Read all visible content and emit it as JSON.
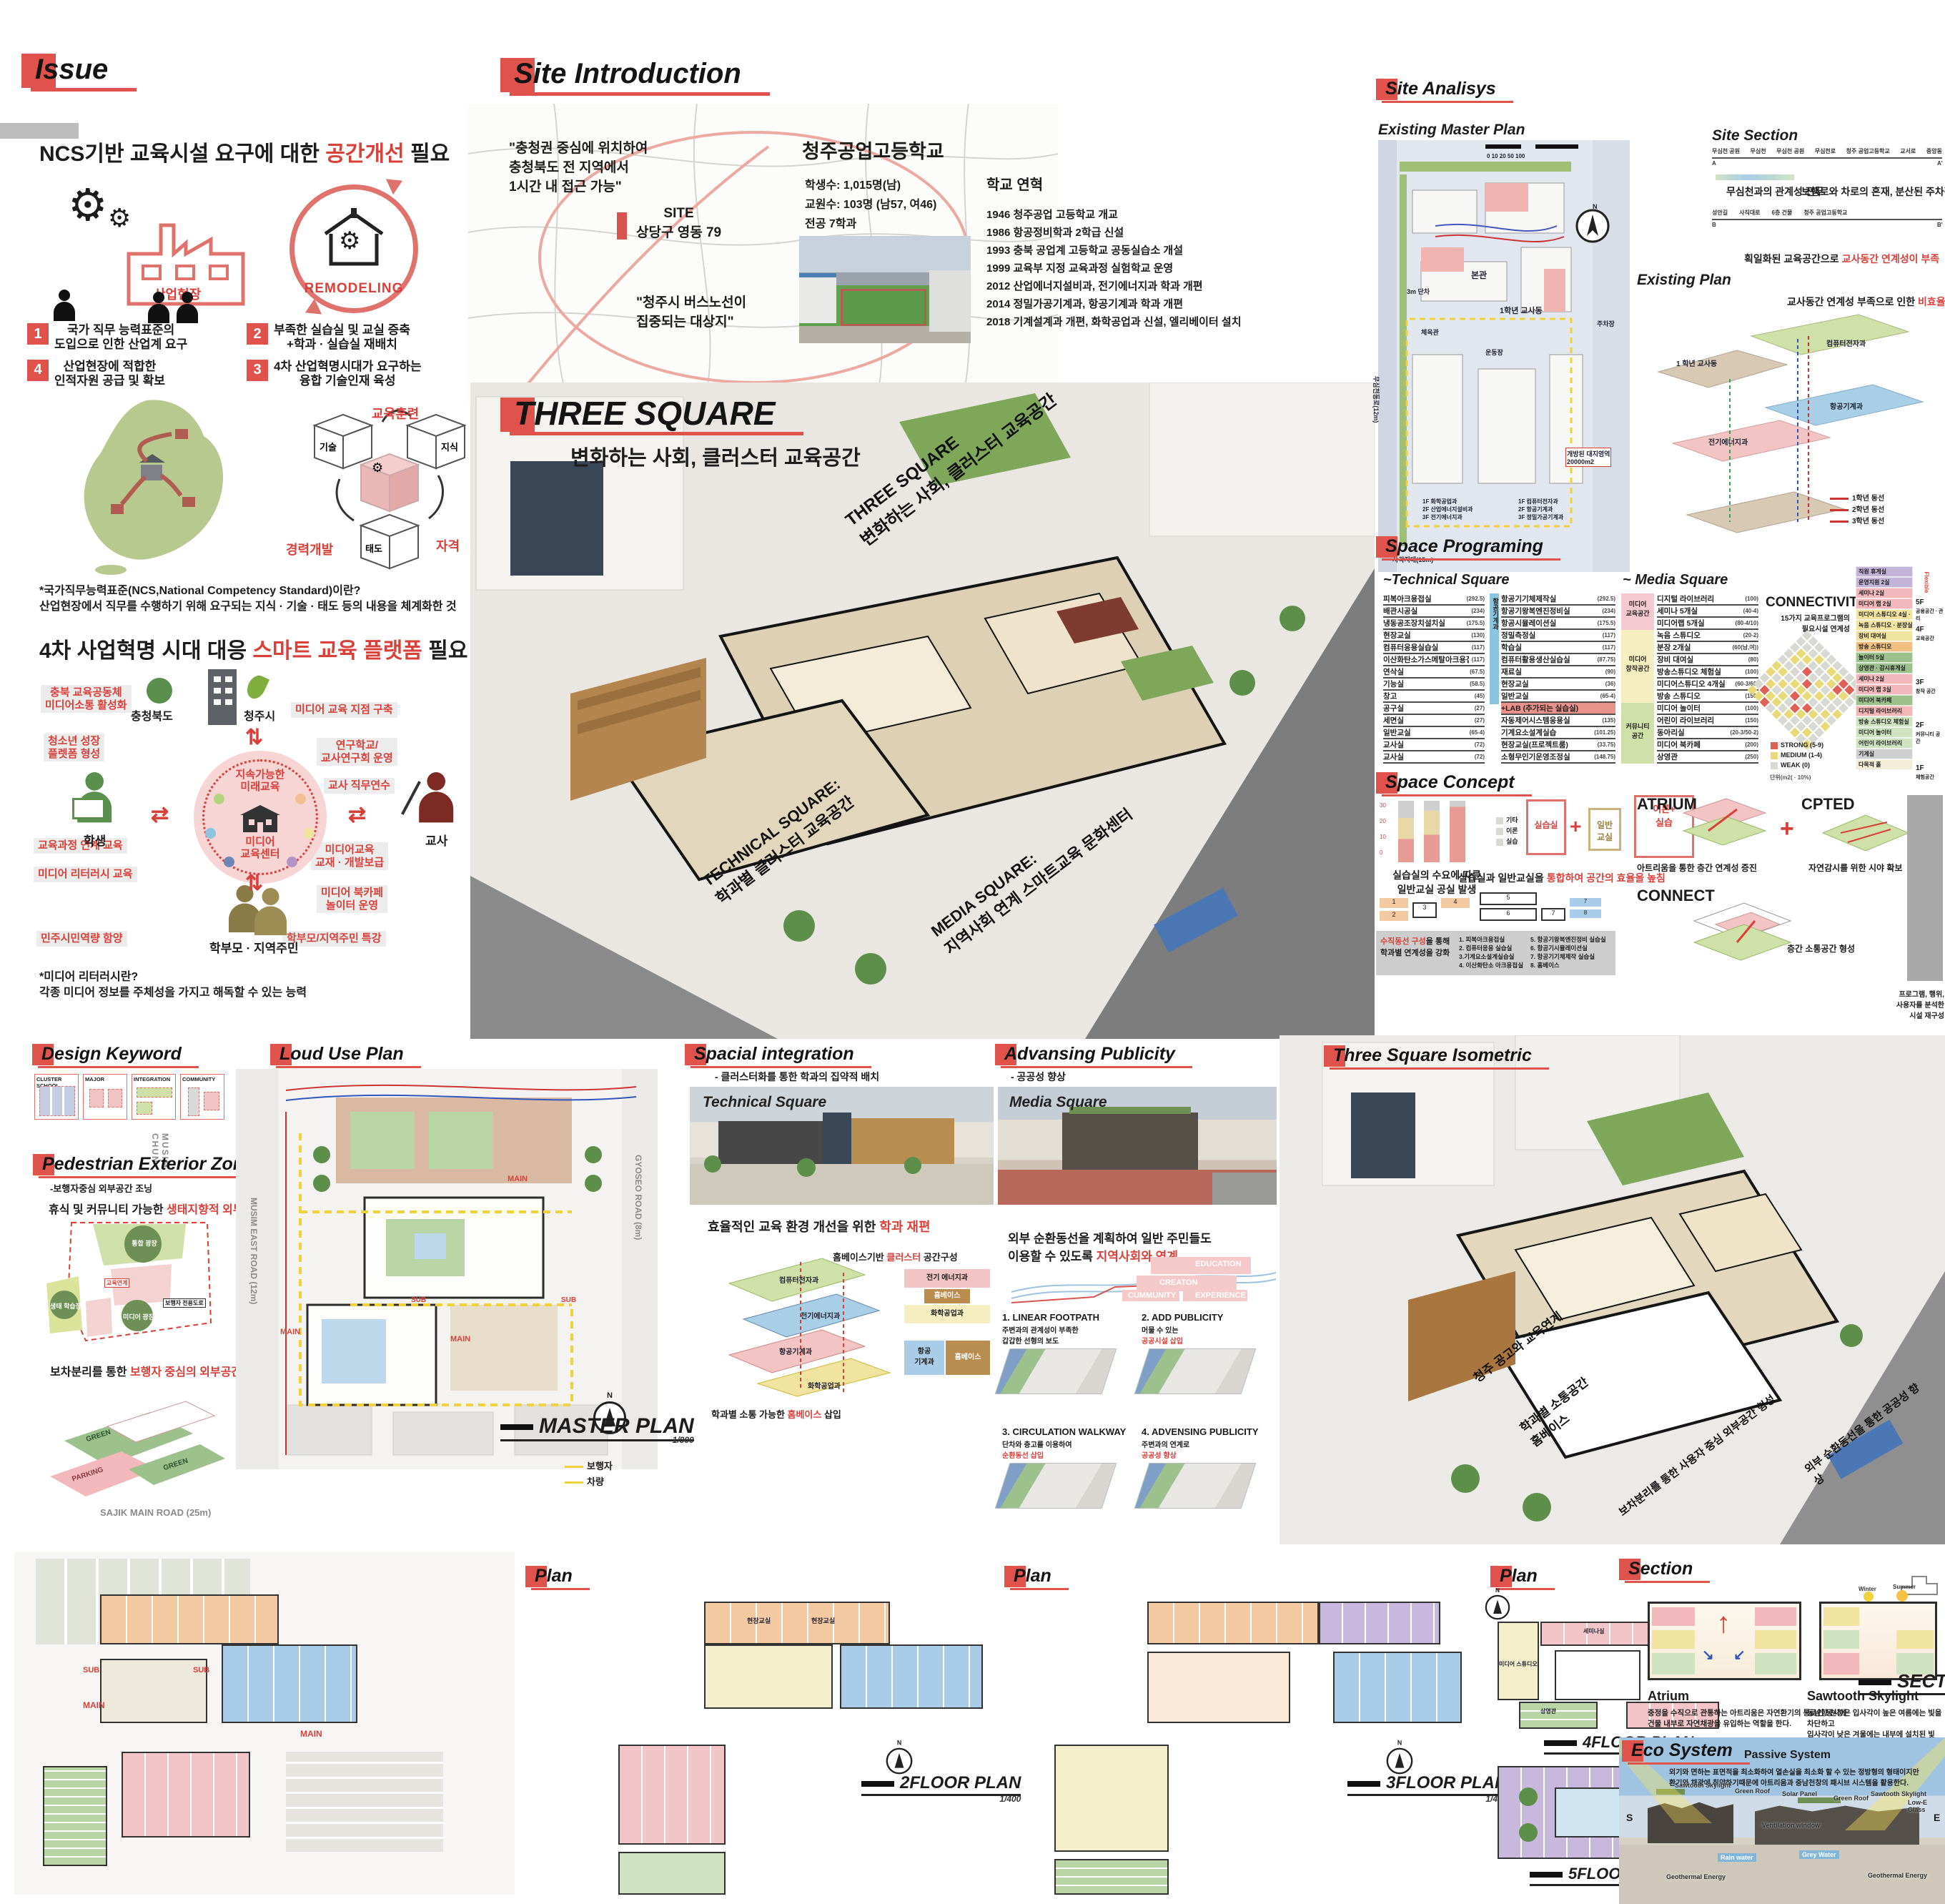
{
  "colors": {
    "accent": "#e0524c",
    "red_text": "#d9403a",
    "pink": "#f2b8bc",
    "yellow": "#f1e3a0",
    "green": "#9dc18c",
    "blue": "#a9cde8",
    "orange": "#f0c083",
    "purple": "#c3b3d6"
  },
  "misc": {
    "n": "N",
    "plus": "+"
  },
  "issue": {
    "header": "Issue",
    "h1_pre": "NCS기반 교육시설 요구에 대한 ",
    "h1_red": "공간개선",
    "h1_post": " 필요",
    "factory_label": "산업현장",
    "remodeling_label": "REMODELING",
    "items": [
      {
        "num": "1",
        "text": "국가 직무 능력표준의\n도입으로 인한 산업계 요구"
      },
      {
        "num": "2",
        "text": "부족한 실습실 및 교실 증축\n+학과 · 실습실 재배치"
      },
      {
        "num": "4",
        "text": "산업현장에 적합한\n인적자원 공급 및 확보"
      },
      {
        "num": "3",
        "text": "4차 산업혁명시대가 요구하는\n융합 기술인재 육성"
      }
    ],
    "cube": {
      "top": "교육훈련",
      "left": "경력개발",
      "right": "자격",
      "c1": "기술",
      "c2": "지식",
      "c3": "태도"
    },
    "note1_title": "*국가직무능력표준(NCS,National Competency Standard)이란?",
    "note1_body": "산업현장에서 직무를 수행하기 위해 요구되는 지식 ·  기술 · 태도 등의 내용을 체계화한 것",
    "h2_pre": "4차 사업혁명 시대 대응 ",
    "h2_red": "스마트 교육 플랫폼",
    "h2_post": " 필요",
    "platform": {
      "org_left": "충청북도",
      "org_right": "청주시",
      "center_top": "지속가능한\n미래교육",
      "center_bottom": "미디어\n교육센터",
      "actor_left": "학생",
      "actor_right": "교사",
      "actor_bottom": "학부모 · 지역주민",
      "tags_left": [
        "충북 교육공동체\n미디어소통 활성화",
        "청소년 성장\n플렛폼 형성",
        "교육과정 연계 교육",
        "미디어 리터러시 교육",
        "민주시민역량 함양"
      ],
      "tags_right": [
        "미디어 교육 지점 구축",
        "연구학교/\n교사연구회 운영",
        "교사 직무연수",
        "미디어교육\n교재 · 개발보급",
        "미디어 북카페\n놀이터 운영",
        "학부모/지역주민 특강"
      ]
    },
    "note2_title": "*미디어 리터러시란?",
    "note2_body": "각종 미디어 정보를 주체성을 가지고 해독할 수 있는 능력"
  },
  "site_intro": {
    "header": "Site Introduction",
    "quote1": "\"충청권 중심에 위치하여\n충청북도 전 지역에서\n1시간 내 접근 가능\"",
    "site_label": "SITE\n상당구 영동 79",
    "quote2": "\"청주시 버스노선이\n집중되는 대상지\"",
    "school_name": "청주공업고등학교",
    "stats": [
      "학생수: 1,015명(남)",
      "교원수: 103명 (남57, 여46)",
      "전공 7학과"
    ],
    "history_title": "학교 연혁",
    "history": [
      "1946 청주공업 고등학교 개교",
      "1986 항공정비학과 2학급 신설",
      "1993 충북 공업계 고등학교 공동실습소 개설",
      "1999 교육부 지정 교육과정 실험학교 운영",
      "2012 산업에너지설비과, 전기에너지과 학과 개편",
      "2014 정밀가공기계과, 항공기계과 학과 개편",
      "2018 기계설계과 개편, 화학공업과 신설, 엘리베이터 설치"
    ]
  },
  "three_square": {
    "title": "THREE SQUARE",
    "subtitle": "변화하는 사회, 클러스터 교육공간",
    "roof_label": "THREE SQUARE\n변화하는 사회, 클러스터 교육공간",
    "technical_label": "TECHNICAL SQUARE:\n학과별 클러스터 교육공간",
    "media_label": "MEDIA SQUARE:\n지역사회 연계 스마트교육 문화센터"
  },
  "analysis": {
    "header": "Site Analisys",
    "master_title": "Existing Master Plan",
    "scalebar": "0  10  20        50                100",
    "plan_labels": {
      "main": "본관",
      "grade1": "1학년 교사동",
      "gym": "체육관",
      "ground": "운동장",
      "parking": "주차장",
      "gap": "3m 단차",
      "blind": "사각지대(15m)",
      "open": "개방된 대지영역\n20000m2",
      "stack1": "1F 화학공업과\n2F 산업에너지설비과\n3F 전기에너지과",
      "stack2": "1F 컴퓨터전자과\n2F 항공기계과\n3F 정밀가공기계과",
      "road": "무심천동로(12m)"
    },
    "section_title": "Site Section",
    "sec1_ticks": [
      "무심천 공원",
      "무심천",
      "무심천 공원",
      "무심천로",
      "청주 공업고등학교",
      "교서로",
      "중앙동"
    ],
    "a": "A",
    "a2": "A'",
    "cap1": "무심천과의 관계성 전무",
    "cap2_pre": "보행로와 차로의 혼재, 분산된 주차장으로인한 ",
    "cap2_red": "비합리적 외부공간",
    "sec2_ticks": [
      "성안길",
      "사직대로",
      "6층 건물",
      "청주 공업고등학교"
    ],
    "b": "B",
    "b2": "B'",
    "cap3_pre": "획일화된 교육공간으로 ",
    "cap3_red": "교사동간 연계성이 부족",
    "plan_title": "Existing Plan",
    "plan_cap_pre": "교사동간 연계성 부족으로 인한 ",
    "plan_cap_red": "비효율적 동선",
    "axon_labels": [
      "1 학년 교사동",
      "컴퓨터전자과",
      "전기에너지과",
      "항공기계과"
    ],
    "legend": [
      {
        "label": "1학년 동선",
        "cls": "lg1"
      },
      {
        "label": "2학년 동선",
        "cls": "lg2"
      },
      {
        "label": "3학년 동선",
        "cls": "lg3"
      }
    ]
  },
  "programing": {
    "header": "Space Programing",
    "tech_title": "~Technical Square",
    "tech_side": "항공기계과",
    "media_title": "~ Media Square",
    "tech_col1": [
      {
        "name": "피복아크용접실",
        "area": "(292.5)"
      },
      {
        "name": "배관시공실",
        "area": "(234)"
      },
      {
        "name": "냉동공조장치설치실",
        "area": "(175.5)"
      },
      {
        "name": "현장교실",
        "area": "(130)"
      },
      {
        "name": "컴퓨터응용실습실",
        "area": "(117)"
      },
      {
        "name": "이산화탄소가스메탈아크용접실",
        "area": "(117)"
      },
      {
        "name": "연삭실",
        "area": "(67.5)"
      },
      {
        "name": "기능실",
        "area": "(58.5)"
      },
      {
        "name": "창고",
        "area": "(45)"
      },
      {
        "name": "공구실",
        "area": "(27)"
      },
      {
        "name": "세면실",
        "area": "(27)"
      },
      {
        "name": "일반교실",
        "area": "(65-4)"
      },
      {
        "name": "교사실",
        "area": "(72)"
      },
      {
        "name": "교사실",
        "area": "(72)"
      }
    ],
    "tech_col2": [
      {
        "name": "항공기기체제작실",
        "area": "(292.5)"
      },
      {
        "name": "항공기왕복엔진정비실",
        "area": "(234)"
      },
      {
        "name": "항공시뮬레이션실",
        "area": "(175.5)"
      },
      {
        "name": "정밀측정실",
        "area": "(117)"
      },
      {
        "name": "학습실",
        "area": "(117)"
      },
      {
        "name": "컴퓨터활용생산실습실",
        "area": "(87.75)"
      },
      {
        "name": "재료실",
        "area": "(90)"
      },
      {
        "name": "현장교실",
        "area": "(36)"
      },
      {
        "name": "일반교실",
        "area": "(65-4)"
      },
      {
        "name": "+LAB (추가되는 실습실)",
        "area": "",
        "cls": "labrow"
      },
      {
        "name": "자동제어시스템응용실",
        "area": "(135)"
      },
      {
        "name": "기계요소설계실습",
        "area": "(101.25)"
      },
      {
        "name": "현장교실(프로젝트룸)",
        "area": "(33.75)"
      },
      {
        "name": "소형무인기운영조정실",
        "area": "(148.75)"
      }
    ],
    "media_cats": [
      {
        "label": "미디어\n교육공간",
        "cls": "mc-pink"
      },
      {
        "label": "미디어\n창작공간",
        "cls": "mc-yellow"
      },
      {
        "label": "커뮤니티\n공간",
        "cls": "mc-green"
      }
    ],
    "media_rooms": [
      {
        "name": "디지털 라이브러리",
        "area": "(100)"
      },
      {
        "name": "세미나 5개실",
        "area": "(40-4)"
      },
      {
        "name": "미디어랩 5개실",
        "area": "(80-4/10)"
      },
      {
        "name": "녹음 스튜디오",
        "area": "(20-2)"
      },
      {
        "name": "분장 2개실",
        "area": "(60(남,여))"
      },
      {
        "name": "장비 대여실",
        "area": "(80)"
      },
      {
        "name": "방송스튜디오 체험실",
        "area": "(100)"
      },
      {
        "name": "미디어스튜디오 4개실",
        "area": "(60-3/60)"
      },
      {
        "name": "방송 스튜디오",
        "area": "(150)"
      },
      {
        "name": "미디어 놀이터",
        "area": "(100)"
      },
      {
        "name": "어린이 라이브러리",
        "area": "(150)"
      },
      {
        "name": "동아리실",
        "area": "(20-3/50-2)"
      },
      {
        "name": "미디어 북카페",
        "area": "(200)"
      },
      {
        "name": "상영관",
        "area": "(250)"
      }
    ],
    "connectivity": {
      "title": "CONNECTIVITY",
      "subtitle": "15가지 교육프로그램의\n필요시설 연계성",
      "legend": [
        {
          "label": "STRONG (5-9)",
          "cls": "ccr"
        },
        {
          "label": "MEDIUM (1-4)",
          "cls": "ccy"
        },
        {
          "label": "WEAK (0)",
          "cls": "ccw"
        }
      ],
      "unit": "단위(m2( · 10%)",
      "matrix": [
        "YWWYYWWWWW",
        "YRYWYWYYWW",
        "RYWYWWWYWW",
        "WYYWYWRWYW",
        "YWWRYRWWWW",
        "WYRWYWYWYW",
        "WWYRWYWYYW",
        "YWWYWWYRRW",
        "WYWWYWWYRW",
        "YWWYWYWWWY"
      ]
    },
    "stack_rows": [
      {
        "label": "직원 휴게실",
        "cls": "sv"
      },
      {
        "label": "운영지원 2실",
        "cls": "sv"
      },
      {
        "label": "세미나 2실",
        "cls": "sp"
      },
      {
        "label": "미디어 랩 2실",
        "cls": "sp"
      },
      {
        "label": "미디어 스튜디오 4실 · 조정실",
        "cls": "sy"
      },
      {
        "label": "녹음 스튜디오 · 분장실 2개실",
        "cls": "sy"
      },
      {
        "label": "장비 대여실",
        "cls": "sy"
      },
      {
        "label": "방송 스튜디오",
        "cls": "so"
      },
      {
        "label": "놀이터 5실",
        "cls": "sg"
      },
      {
        "label": "상영관 · 감시휴게실",
        "cls": "sg"
      },
      {
        "label": "세미나 2실",
        "cls": "sp"
      },
      {
        "label": "미디어 랩 3실",
        "cls": "sp"
      },
      {
        "label": "미디어 북카페",
        "cls": "sg"
      },
      {
        "label": "디지털 라이브러리",
        "cls": "srd"
      },
      {
        "label": "방송 스튜디오 체험실",
        "cls": "sg2"
      },
      {
        "label": "미디어 놀이터",
        "cls": "sg2"
      },
      {
        "label": "어린이 라이브러리",
        "cls": "sg2"
      },
      {
        "label": "기계실",
        "cls": "sgr"
      },
      {
        "label": "다목적 홀",
        "cls": "scr"
      }
    ],
    "stack_floors": [
      {
        "f": "5F",
        "zone": "공용공간 · 관리"
      },
      {
        "f": "4F",
        "zone": "교육공간"
      },
      {
        "f": "3F",
        "zone": "창작 공간"
      },
      {
        "f": "2F",
        "zone": "커뮤니티 공간"
      },
      {
        "f": "1F",
        "zone": "체험공간"
      }
    ],
    "flexible": "Flexible"
  },
  "concept": {
    "header": "Space Concept",
    "ticks": [
      "30",
      "20",
      "10",
      "0"
    ],
    "bar_legend": [
      "기타",
      "이론",
      "실습"
    ],
    "bars_caption": "실습실의 수요에 따른\n일반교실 공실 발생",
    "box_a": "실습실",
    "box_b": "일반\n교실",
    "box_c": "이론+\n실습",
    "cap2_pre": "실습실과 일반교실을 ",
    "cap2_red": "통합하여 공간의 효율을 높침",
    "cap3_red": "수직동선 구성",
    "cap3_post": "을 통해\n학과별 연계성을 강화",
    "legend1": [
      "1. 피복아크용접실",
      "2. 컴퓨터응용 실습실",
      "3.기계요소설계실습실",
      "4. 이산화탄소 아크용접실"
    ],
    "legend2": [
      "5. 항공기왕복엔진정비 실습실",
      "6. 항공기시뮬레이션실",
      "7. 항공기기체제작 실습실",
      "8. 홈베이스"
    ],
    "atrium_title": "ATRIUM",
    "atrium_cap": "아트리움을 통한 층간 연계성 증진",
    "cpted_title": "CPTED",
    "cpted_cap": "자연감시를 위한 시야 확보",
    "connect_title": "CONNECT",
    "connect_cap": "층간 소통공간 형성",
    "side_note": "프로그램, 행위,\n사용자를 분석한\n시설 재구성"
  },
  "keyword": {
    "header": "Design Keyword",
    "boxes": [
      {
        "title": "CLUSTER SCHOOL"
      },
      {
        "title": "MAJOR"
      },
      {
        "title": "INTEGRATION"
      },
      {
        "title": "COMMUNITY"
      }
    ],
    "musim": "MUSIM\nCHUN"
  },
  "pedestrian": {
    "header": "Pedestrian Exterior Zoning",
    "subtitle": "-보행자중심 외부공간 조닝",
    "cap1_pre": "휴식 및 커뮤니티 가능한 ",
    "cap1_red": "생태지향적 외부공간",
    "cap1_post": " 조성",
    "zones": [
      "통합 광장",
      "생태 학습장",
      "미디어 광장",
      "교육연계",
      "보행자 전용도로"
    ],
    "cap2_pre": "보차분리를 통한 ",
    "cap2_red": "보행자 중심의 외부공간",
    "cap2_post": " 조닝",
    "green_label": "GREEN",
    "parking_label": "PARKING"
  },
  "loud": {
    "header": "Loud Use Plan",
    "roads": {
      "left": "MUSIM EAST ROAD (12m)",
      "right": "GYOSEO ROAD (8m)",
      "bottom": "SAJIK MAIN ROAD (25m)"
    },
    "main": "MAIN",
    "sub": "SUB",
    "plan_label": "MASTER PLAN",
    "scale": "1/800",
    "legend": [
      {
        "label": "보행자",
        "cls": "lped"
      },
      {
        "label": "차량",
        "cls": "lveh"
      }
    ]
  },
  "integration": {
    "header": "Spacial integration",
    "subtitle": "- 클러스터화를 통한 학과의 집약적 배치",
    "photo_label": "Technical Square",
    "cap_pre": "효율적인 교육 환경 개선을 위한 ",
    "cap_red": "학과 재편",
    "axon_pre": "홈베이스기반 ",
    "axon_red": "클러스터",
    "axon_post": " 공간구성",
    "axon_labels": [
      "컴퓨터전자과",
      "전기에너지과",
      "항공기계과",
      "화학공업과"
    ],
    "hb_cap_pre": "학과별 소통 가능한 ",
    "hb_red": "홈베이스",
    "hb_post": " 삽입",
    "hb1": [
      "전기 에너지과",
      "홈베이스",
      "화학공업과"
    ],
    "hb2": [
      "항공\n기계과",
      "홈베이스"
    ]
  },
  "publicity": {
    "header": "Advansing Publicity",
    "subtitle": "- 공공성 향상",
    "photo_label": "Media Square",
    "cap_pre": "외부 순환동선을 계획하여 일반 주민들도\n이용할 수 있도록 ",
    "cap_red": "지역사회와 연계",
    "terrace": [
      "EDUCATION",
      "CREATON",
      "CUMMUNITY",
      "EXPERIENCE"
    ],
    "steps": [
      {
        "title": "1. LINEAR FOOTPATH",
        "body": "주변과의 관계성이 부족한\n갑갑한 선형의 보도",
        "red": ""
      },
      {
        "title": "2. ADD PUBLICITY",
        "body": "머물 수 있는",
        "red": "공공시설 삽입"
      },
      {
        "title": "3. CIRCULATION WALKWAY",
        "body": "단차와 층고를 이용하여",
        "red": "순환동선 삽입"
      },
      {
        "title": "4. ADVENSING PUBLICITY",
        "body": "주변과의 연계로",
        "red": "공공성 향상"
      }
    ]
  },
  "isometric": {
    "header": "Three Square Isometric",
    "ann": [
      "청주 공고와 교육연계",
      "학과별 소통공간\n홈베이스",
      "보차분리를 통한 사용자 중심 외부공간 형성",
      "외부 순환동선을 통한 공공성 향상"
    ]
  },
  "plans": {
    "p2": {
      "header": "Plan",
      "label": "2FLOOR PLAN",
      "scale": "1/400"
    },
    "p3": {
      "header": "Plan",
      "label": "3FLOOR PLAN",
      "scale": "1/400"
    },
    "p45": {
      "header": "Plan",
      "label4": "4FLOOR PLAN",
      "label5": "5FLOOR PLAN",
      "scale": "1/400"
    },
    "rooms2": [
      "현장교실",
      "현장교실"
    ],
    "rooms4": [
      "세미나실",
      "강사실",
      "미디어 스튜디오",
      "상영관"
    ],
    "rooms5": [
      "직원 휴게실"
    ],
    "main": "MAIN",
    "sub": "SUB"
  },
  "section": {
    "header": "Section",
    "atrium_title": "Atrium",
    "atrium_body": "중정을 수직으로 관통하는 아트리움은 자연환기의 통로인 동시에\n건물 내부로 자연채광을 유입하는 역할을 한다.",
    "saw_title": "Sawtooth Skylight",
    "saw_body": "동남향 천창은 입사각이 높은 여름에는 빛을 차단하고\n입사각이 낮은 겨울에는 내부에 설치된 빛 반사판을 통해 주광을 도입한다.",
    "label": "SECTION",
    "scale": "1/400",
    "winter": "Winter",
    "summer": "Summer"
  },
  "eco": {
    "header": "Eco System",
    "title": "Passive System",
    "body": "외기와 면하는 표면적을 최소화하여 열손실을 최소화 할 수 있는 정방형의 형태이지만\n환기와 채광에 취약하기때문에 아트리움과 중남천창의 패시브 시스템을 활용한다.",
    "labels": [
      "Sawtooth Skylight",
      "Green Roof",
      "Solar Panel",
      "Ventilation window",
      "Grey Water",
      "Rain water",
      "Geothermal Energy",
      "Low-E Glass"
    ],
    "s": "S",
    "e": "E"
  }
}
